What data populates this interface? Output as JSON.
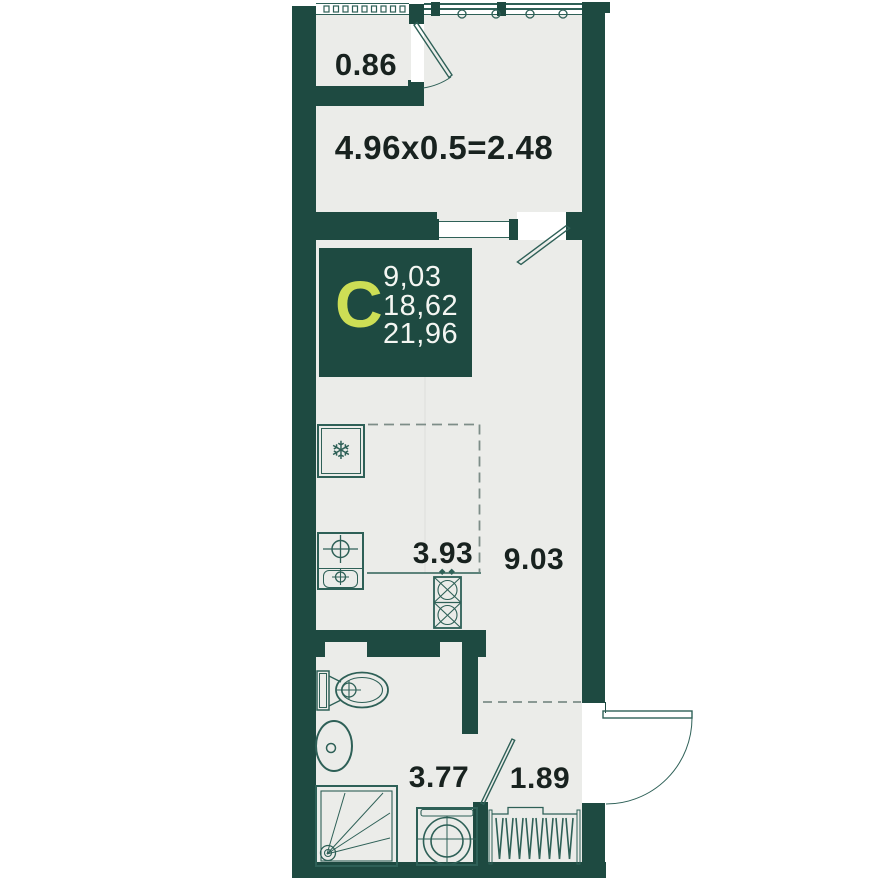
{
  "plan": {
    "badge": {
      "type_letter": "С",
      "areas": [
        "9,03",
        "18,62",
        "21,96"
      ]
    },
    "labels": {
      "closet_area": "0.86",
      "balcony_area_formula": "4.96x0.5=2.48",
      "kitchen_zone_area": "3.93",
      "living_area": "9.03",
      "bathroom_area": "3.77",
      "hallway_area": "1.89"
    },
    "icons": {
      "fridge": "snowflake-icon"
    },
    "colors": {
      "wall": "#1e4a41",
      "floor": "#ebece9",
      "fixture_stroke": "#2e6057",
      "accent_lime": "#cdde55",
      "label_text": "#18221f",
      "badge_text": "#f4f6f2",
      "dashed_line": "#7d8d88"
    }
  }
}
